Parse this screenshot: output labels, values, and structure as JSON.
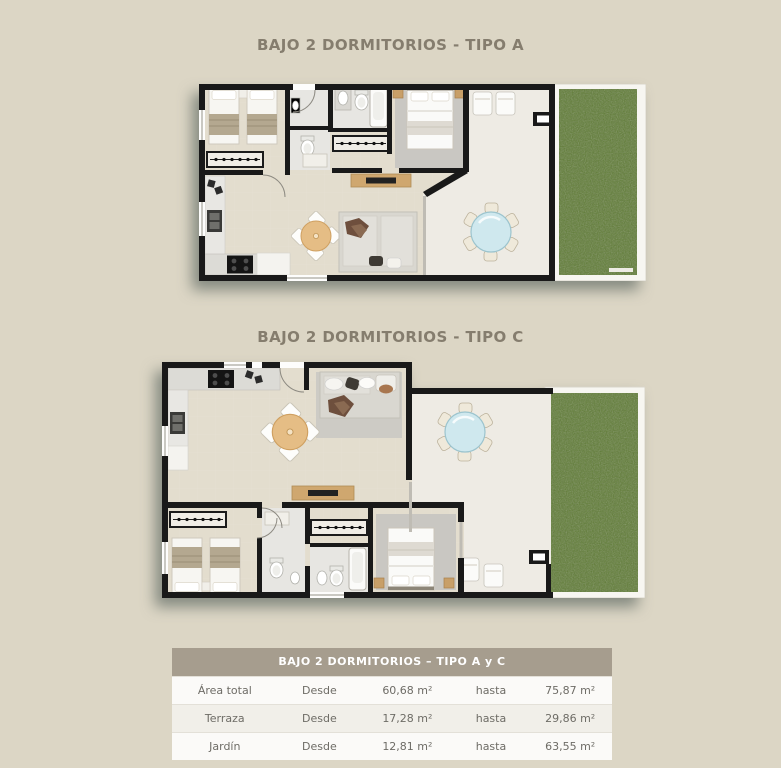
{
  "page": {
    "background_color": "#dcd6c5",
    "wall_color": "#191919",
    "garden_color": "#5e7b33",
    "title_color": "#857d6e"
  },
  "plans": [
    {
      "title": "BAJO 2 DORMITORIOS - TIPO A"
    },
    {
      "title": "BAJO 2 DORMITORIOS - TIPO C"
    }
  ],
  "table": {
    "header": "BAJO 2 DORMITORIOS – TIPO A y C",
    "header_bg": "#a69d8e",
    "rows": [
      {
        "label": "Área total",
        "from_label": "Desde",
        "from_value": "60,68 m²",
        "to_label": "hasta",
        "to_value": "75,87 m²"
      },
      {
        "label": "Terraza",
        "from_label": "Desde",
        "from_value": "17,28 m²",
        "to_label": "hasta",
        "to_value": "29,86 m²"
      },
      {
        "label": "Jardín",
        "from_label": "Desde",
        "from_value": "12,81 m²",
        "to_label": "hasta",
        "to_value": "63,55 m²"
      }
    ]
  }
}
